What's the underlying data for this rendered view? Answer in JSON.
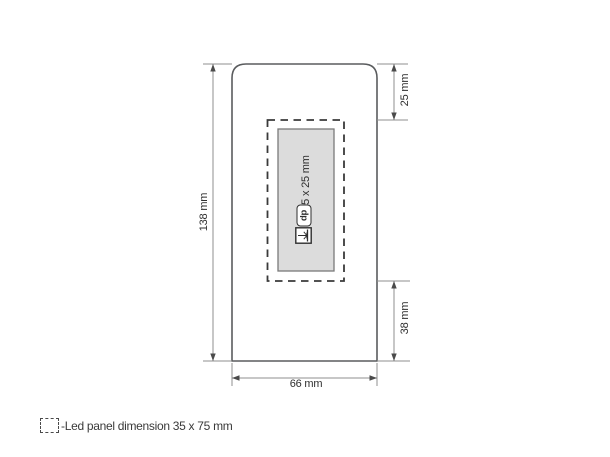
{
  "drawing": {
    "type": "product-dimension-diagram",
    "dimensions": {
      "height": "138 mm",
      "top_offset": "25 mm",
      "bottom_offset": "38 mm",
      "width": "66 mm"
    },
    "print_area": {
      "size_label": "65 x 25 mm",
      "dp_icon_text": "dp",
      "icons": [
        "digital-print-icon",
        "laser-engraving-icon"
      ]
    },
    "legend": {
      "label": "-Led panel dimension 35 x 75 mm"
    },
    "colors": {
      "background": "#ffffff",
      "product_outline": "#5a5c5e",
      "dimension_lines": "#8f8f8f",
      "arrowheads": "#4a4a4a",
      "dashed_panel_outline": "#3a3a3a",
      "print_area_fill": "#dcdcdc",
      "print_area_border": "#7a7a7a",
      "text": "#2f2f2f"
    }
  }
}
